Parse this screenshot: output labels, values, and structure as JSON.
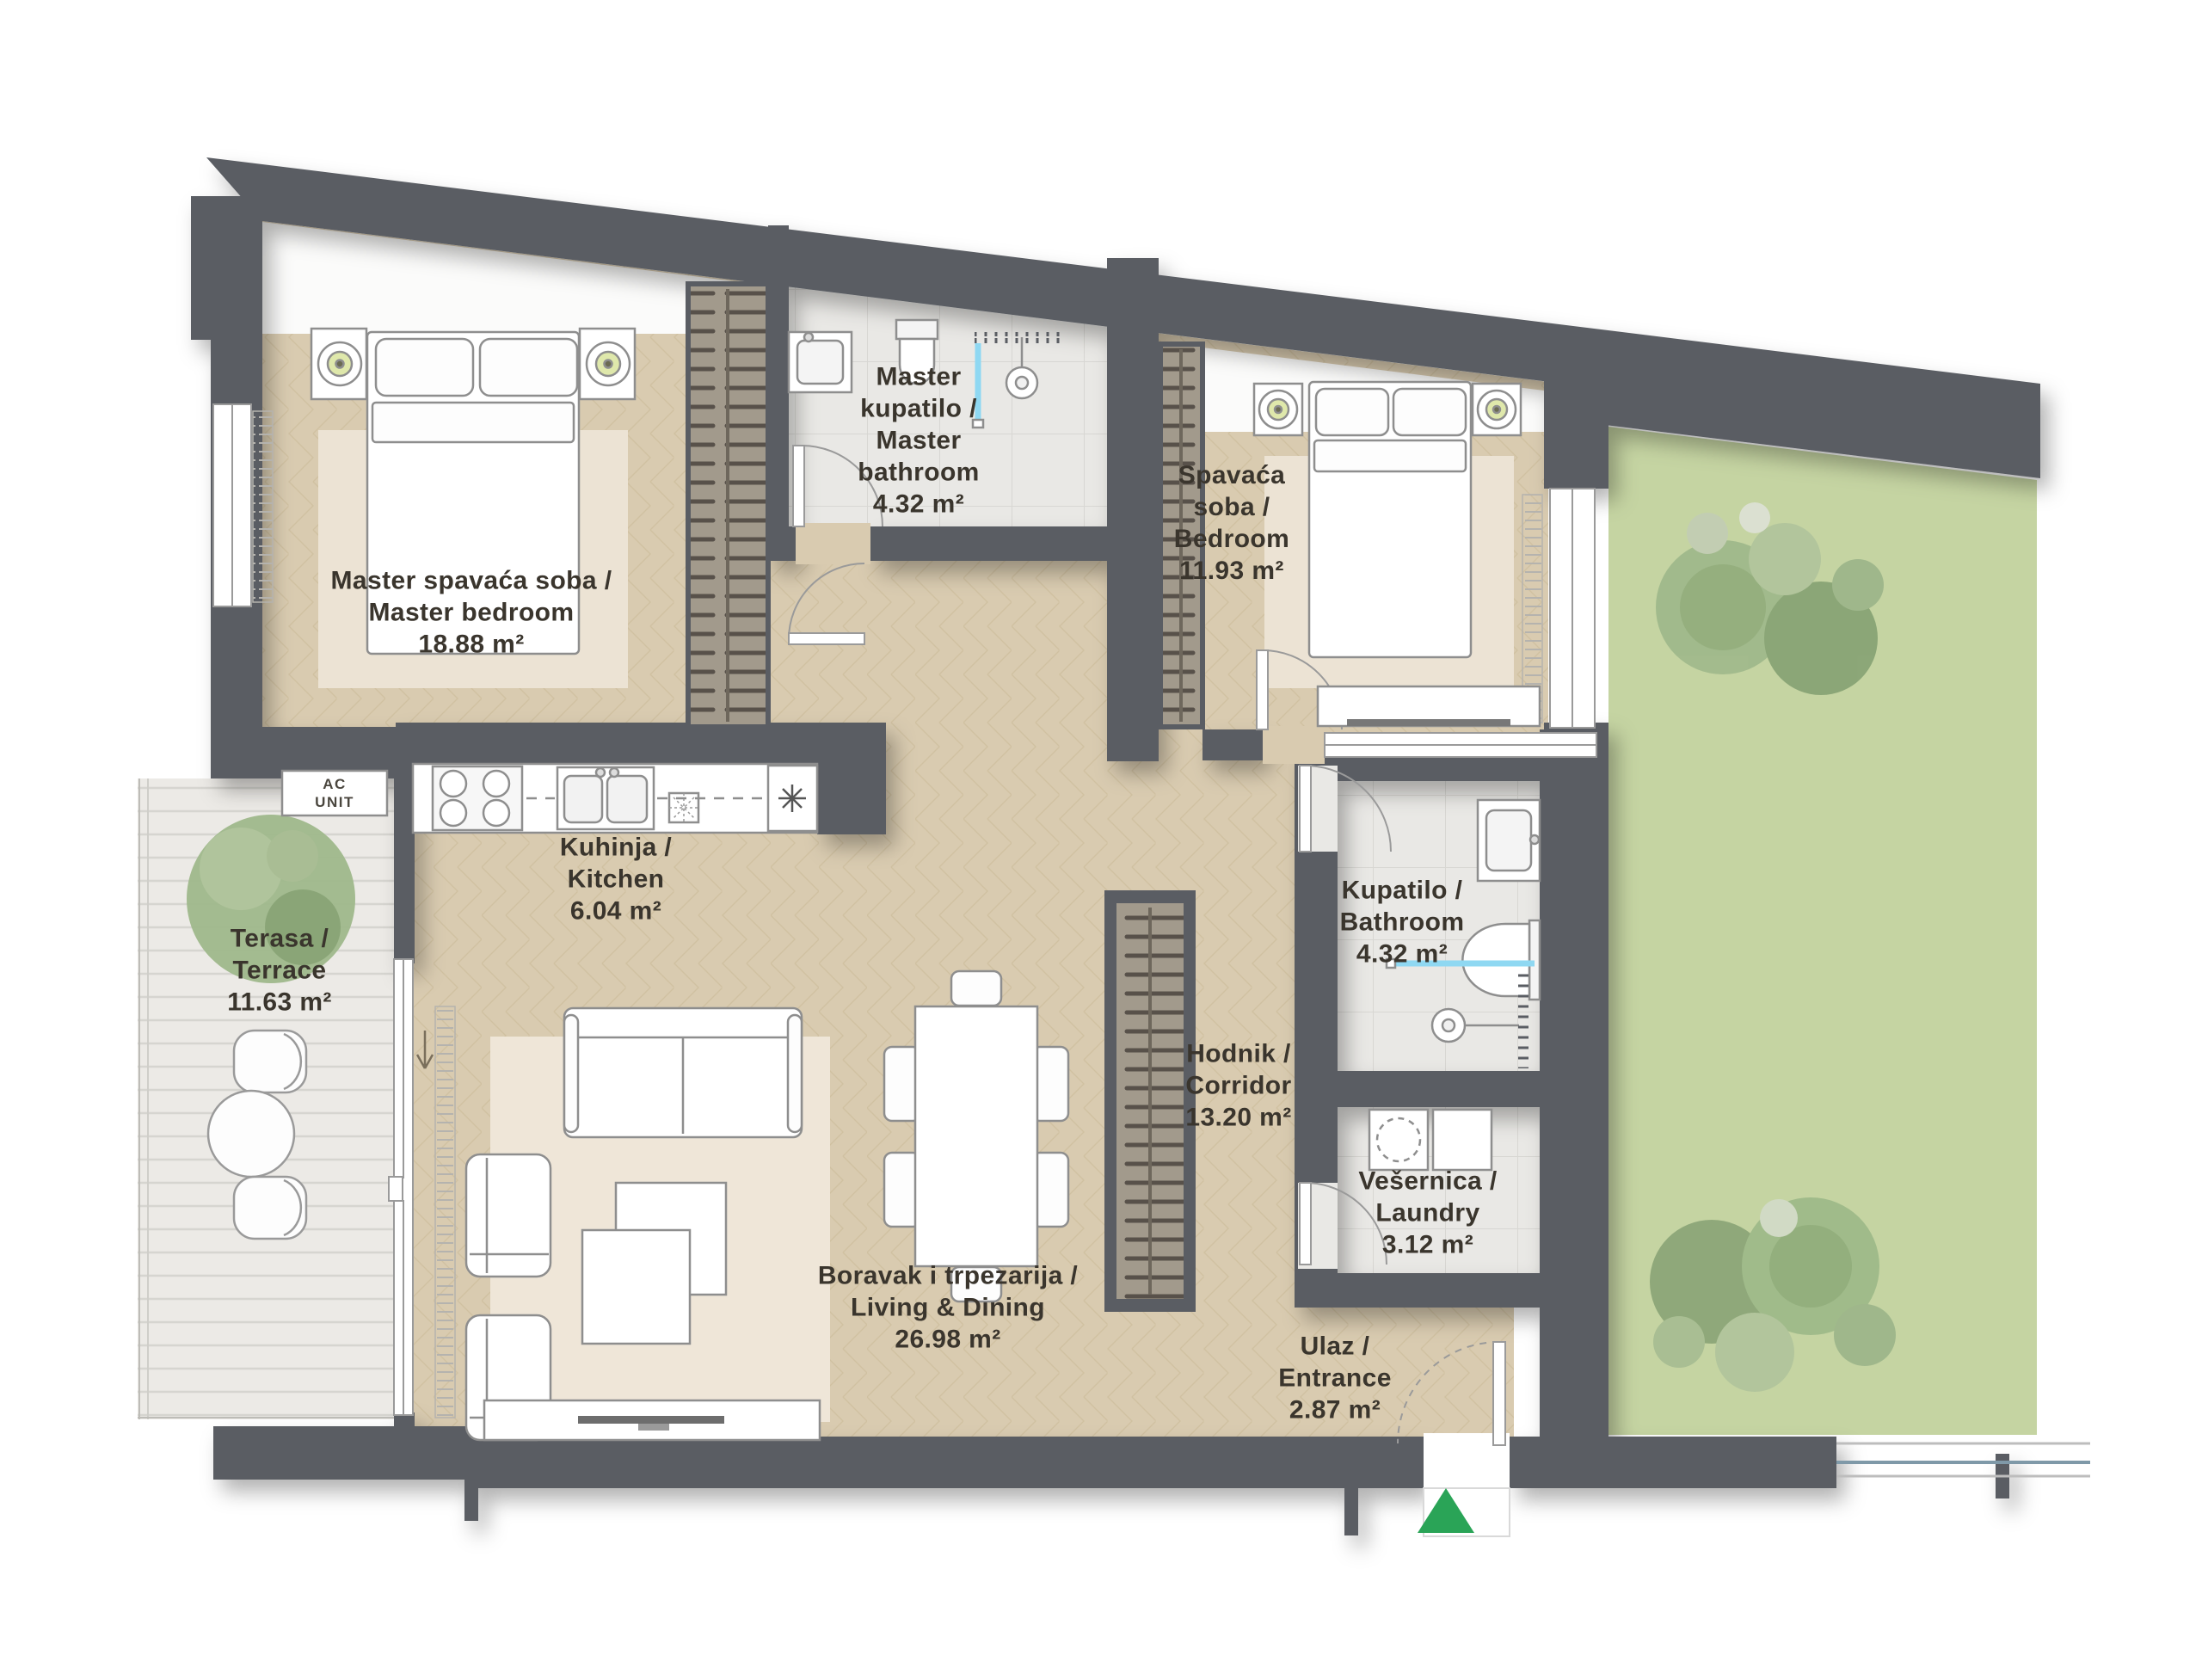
{
  "plan": {
    "title": "Apartment floor plan",
    "rooms": [
      {
        "id": "master-bedroom",
        "name_lines": [
          "Master spavaća soba /",
          "Master bedroom"
        ],
        "area": "18.88 m²"
      },
      {
        "id": "master-bathroom",
        "name_lines": [
          "Master",
          "kupatilo /",
          "Master",
          "bathroom"
        ],
        "area": "4.32 m²"
      },
      {
        "id": "bedroom",
        "name_lines": [
          "Spavaća",
          "soba /",
          "Bedroom"
        ],
        "area": "11.93 m²"
      },
      {
        "id": "kitchen",
        "name_lines": [
          "Kuhinja /",
          "Kitchen"
        ],
        "area": "6.04 m²"
      },
      {
        "id": "terrace",
        "name_lines": [
          "Terasa /",
          "Terrace"
        ],
        "area": "11.63 m²"
      },
      {
        "id": "bathroom",
        "name_lines": [
          "Kupatilo /",
          "Bathroom"
        ],
        "area": "4.32 m²"
      },
      {
        "id": "corridor",
        "name_lines": [
          "Hodnik /",
          "Corridor"
        ],
        "area": "13.20 m²"
      },
      {
        "id": "laundry",
        "name_lines": [
          "Vešernica /",
          "Laundry"
        ],
        "area": "3.12 m²"
      },
      {
        "id": "living-dining",
        "name_lines": [
          "Boravak i trpezarija /",
          "Living & Dining"
        ],
        "area": "26.98 m²"
      },
      {
        "id": "entrance",
        "name_lines": [
          "Ulaz /",
          "Entrance"
        ],
        "area": "2.87 m²"
      }
    ],
    "ac_unit_label_lines": [
      "AC",
      "UNIT"
    ],
    "entrance_marker": {
      "icon": "triangle-up-icon",
      "color": "#2aa457"
    },
    "colors": {
      "walls": "#5a5d63",
      "floor_wood": "#d9cbb0",
      "floor_tile": "#e9e8e5",
      "terrace_deck": "#eceae6",
      "garden": "#c5d4a2",
      "rug": "#efe6d8",
      "accent_green": "#2aa457",
      "shower_blue": "#8fd8f2",
      "text": "#3a352d"
    }
  }
}
